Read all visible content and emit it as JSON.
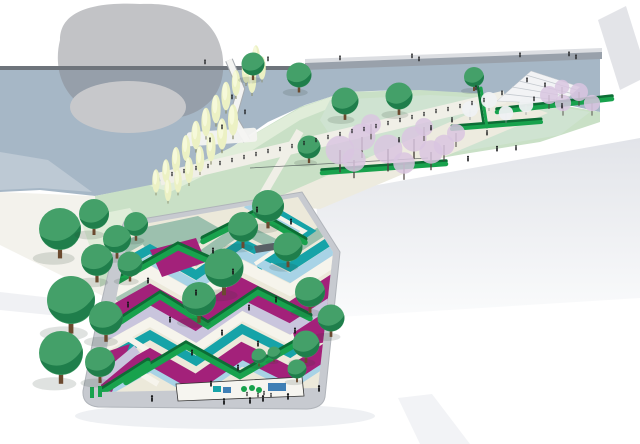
{
  "scene": {
    "type": "axonometric-landscape-masterplan-illustration",
    "elements": [
      "river",
      "bridge-line",
      "canopy-cloud",
      "river-island",
      "riverside-lawn",
      "poplar-trees",
      "round-green-trees",
      "blossom-trees",
      "hedge-walls",
      "promenade-crowd",
      "striped-plaza",
      "plaza-platform",
      "playground-area",
      "floating-deck",
      "riverbank-stairs",
      "corner-road-band"
    ]
  },
  "palette": {
    "water": "#a6b7c6",
    "water_light": "#bdc9d4",
    "island": "#c7c8cb",
    "cloud": "#85888d",
    "bridge": "#6e747b",
    "bank_cap": "#99a1ab",
    "cap_highlight": "#dcdee2",
    "corner_band": "#e3e4e8",
    "wall": "#f3f2ec",
    "lawn": "#c9e0c6",
    "lawn_light": "#e0edd9",
    "lawn_right": "#cfe3d1",
    "esplanade": "#edebdf",
    "promenade": "#f0efe7",
    "plaza_base": "#ece9da",
    "platform": "#c7cad0",
    "magenta": "#a3217a",
    "teal": "#16a3a8",
    "light_blue": "#a8d3e6",
    "lavender": "#c9c5dd",
    "sage": "#9cc0ae",
    "stripe_white": "#f6f4ec",
    "hedge_bright": "#18a24d",
    "hedge_dark": "#0d6d35",
    "tree_light": "#44a069",
    "tree_dark": "#1c7a48",
    "trunk": "#6b4a2f",
    "poplar": "#ecf1c4",
    "poplar_light": "#f7f9dd",
    "blossom": "#d9c6e0",
    "white_tree": "#eff1f3",
    "people": "#17181a",
    "ramp_white": "#f4f4f2",
    "stair_white": "#f2f3f5",
    "play_blue": "#3f7fb5",
    "bench_gray": "#596066"
  }
}
